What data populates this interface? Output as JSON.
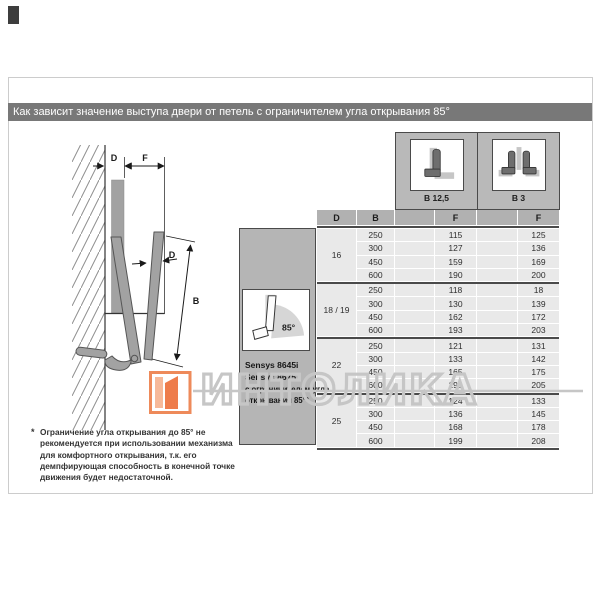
{
  "title_bar": {
    "text": "Как зависит значение выступа двери от петель с ограничителем угла открывания 85°"
  },
  "diagram": {
    "dim_d_top": "D",
    "dim_f_top": "F",
    "dim_d_door": "D",
    "dim_b": "B"
  },
  "hinge_header": {
    "left": {
      "icon": "overlay-hinge-icon",
      "label": "B 12,5"
    },
    "right": {
      "icon": "twin-hinge-icon",
      "label": "B 3"
    }
  },
  "sidebar": {
    "product_line1": "Sensys 8645i",
    "product_line2": "Sensys 8675",
    "note_line1": "с ограничителем угла",
    "note_line2": "открывания 85°*",
    "angle": "85°"
  },
  "chart_data": {
    "type": "table",
    "headers": [
      "D",
      "B",
      "F",
      "F"
    ],
    "hinge_variants": [
      "B 12,5",
      "B 3"
    ],
    "groups": [
      {
        "d": "16",
        "rows": [
          [
            250,
            115,
            125
          ],
          [
            300,
            127,
            136
          ],
          [
            450,
            159,
            169
          ],
          [
            600,
            190,
            200
          ]
        ]
      },
      {
        "d": "18 / 19",
        "rows": [
          [
            250,
            118,
            18
          ],
          [
            300,
            130,
            139
          ],
          [
            450,
            162,
            172
          ],
          [
            600,
            193,
            203
          ]
        ]
      },
      {
        "d": "22",
        "rows": [
          [
            250,
            121,
            131
          ],
          [
            300,
            133,
            142
          ],
          [
            450,
            165,
            175
          ],
          [
            600,
            196,
            205
          ]
        ]
      },
      {
        "d": "25",
        "rows": [
          [
            250,
            124,
            133
          ],
          [
            300,
            136,
            145
          ],
          [
            450,
            168,
            178
          ],
          [
            600,
            199,
            208
          ]
        ]
      }
    ]
  },
  "footnote": {
    "marker": "*",
    "lines": [
      "Ограничение угла открывания до 85° не",
      "рекомендуется при использовании механизма",
      "для комфортного открывания, т.к. его",
      "демпфирующая способность в конечной точке",
      "движения будет недостаточной."
    ]
  },
  "watermark": {
    "text": "ИНТОЛИКА"
  },
  "colors": {
    "title_bar": "#787878",
    "header_cell": "#b1b1b1",
    "row_cell": "#e9e9e9",
    "panel_gray": "#b9b9b9",
    "dark_border": "#4a4a4a",
    "watermark_gray": "#c6c6c6",
    "logo_orange": "#ee8a5a"
  }
}
